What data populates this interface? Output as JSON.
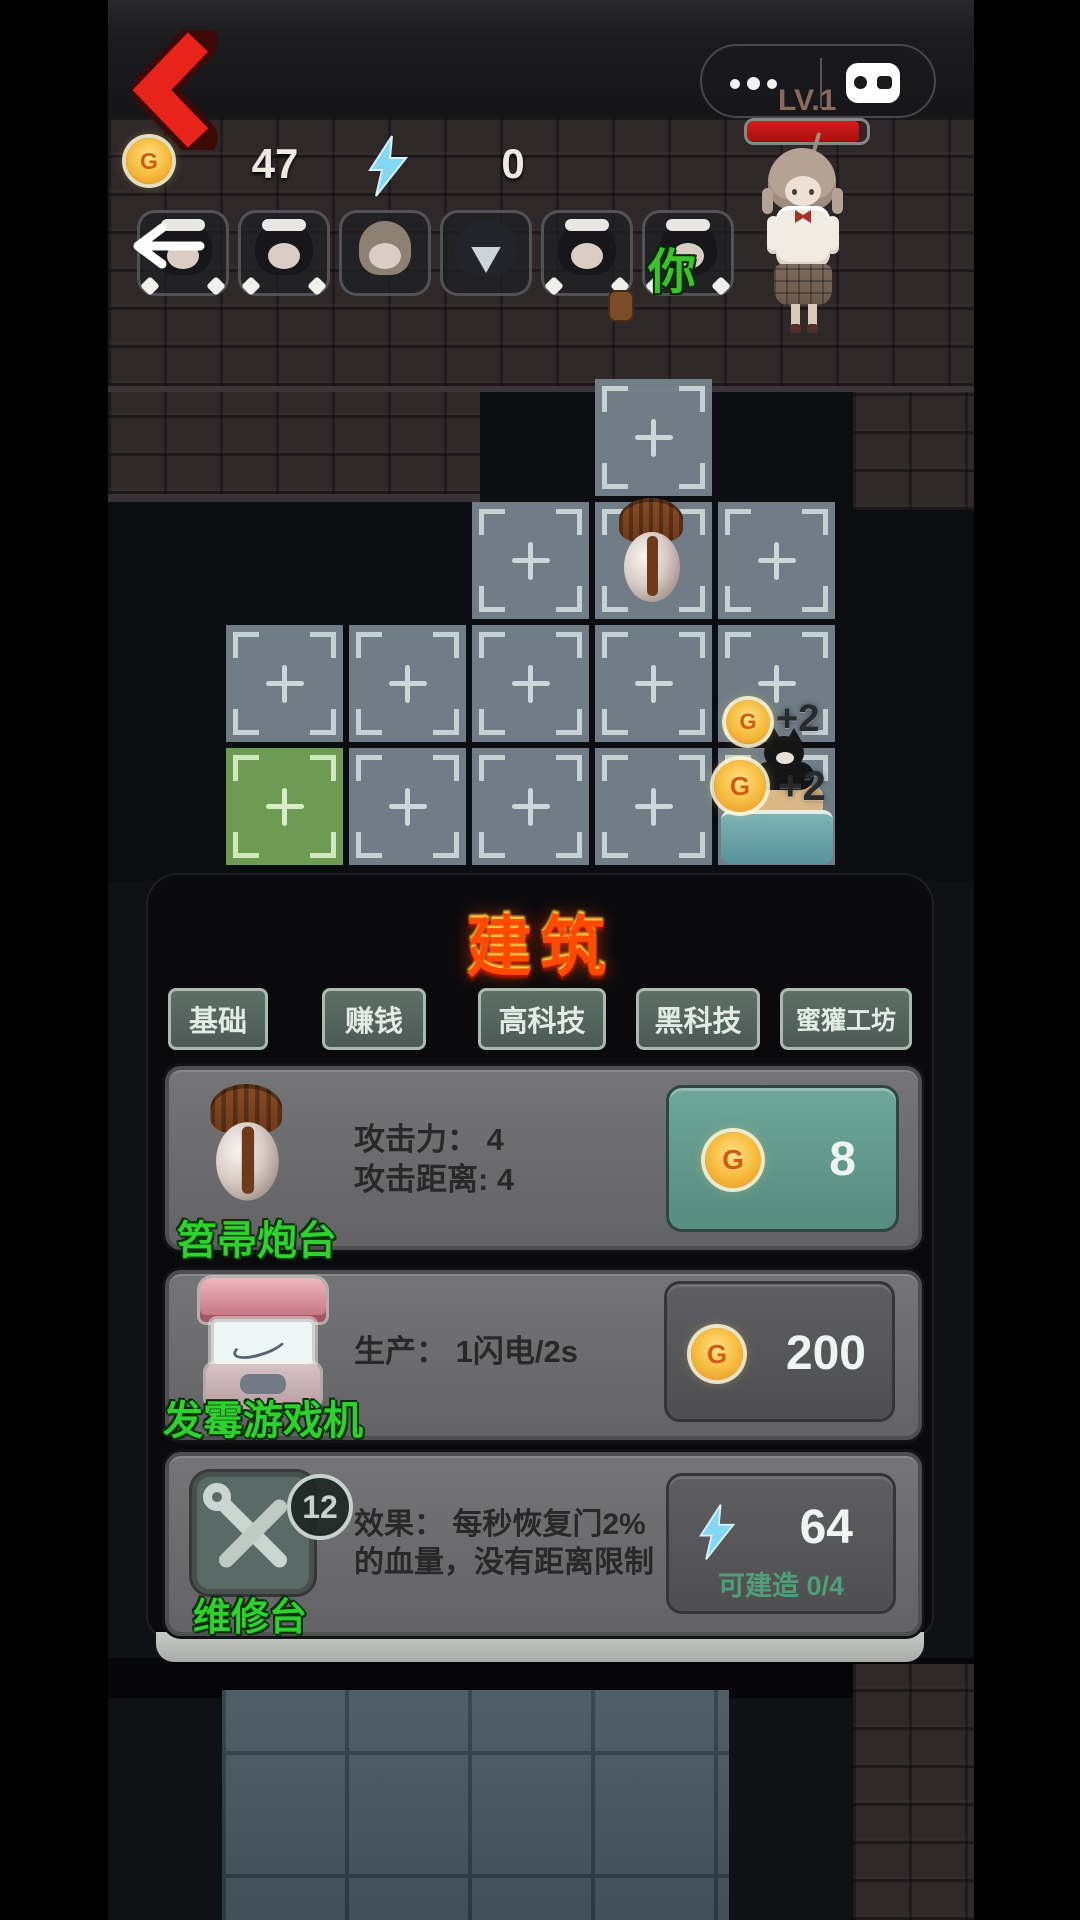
{
  "header": {
    "lv_label": "LV.1",
    "icons": {
      "back": "red-chevron-left",
      "capsule_menu": "three-dots",
      "capsule_pad": "gamepad",
      "gold": "coin-G",
      "energy": "lightning-bolt"
    }
  },
  "resources": {
    "gold": "47",
    "energy": "0",
    "gold_letter": "G"
  },
  "team": {
    "you_label": "你"
  },
  "grid": {
    "popups": [
      "+2",
      "+2"
    ]
  },
  "panel": {
    "title": "建筑",
    "tabs": [
      "基础",
      "赚钱",
      "高科技",
      "黑科技",
      "蜜獾工坊"
    ],
    "cards": [
      {
        "name": "笤帚炮台",
        "stats": [
          "攻击力： 4",
          "攻击距离: 4"
        ],
        "cost": "8",
        "currency": "gold"
      },
      {
        "name": "发霉游戏机",
        "stats": [
          "生产： 1闪电/2s"
        ],
        "cost": "200",
        "currency": "gold"
      },
      {
        "name": "维修台",
        "badge": "12",
        "stats": [
          "效果： 每秒恢复门2%",
          "的血量，没有距离限制"
        ],
        "cost": "64",
        "currency": "energy",
        "note": "可建造 0/4"
      }
    ]
  },
  "colors": {
    "gold": "#f2b23a",
    "energy": "#7fd7f2",
    "name_green": "#2fd12f",
    "title_red": "#ff4a00",
    "health_red": "#bf1414",
    "tile_grey": "#76848c",
    "tile_green": "#71a156",
    "affordable_button": "#5f948a"
  }
}
